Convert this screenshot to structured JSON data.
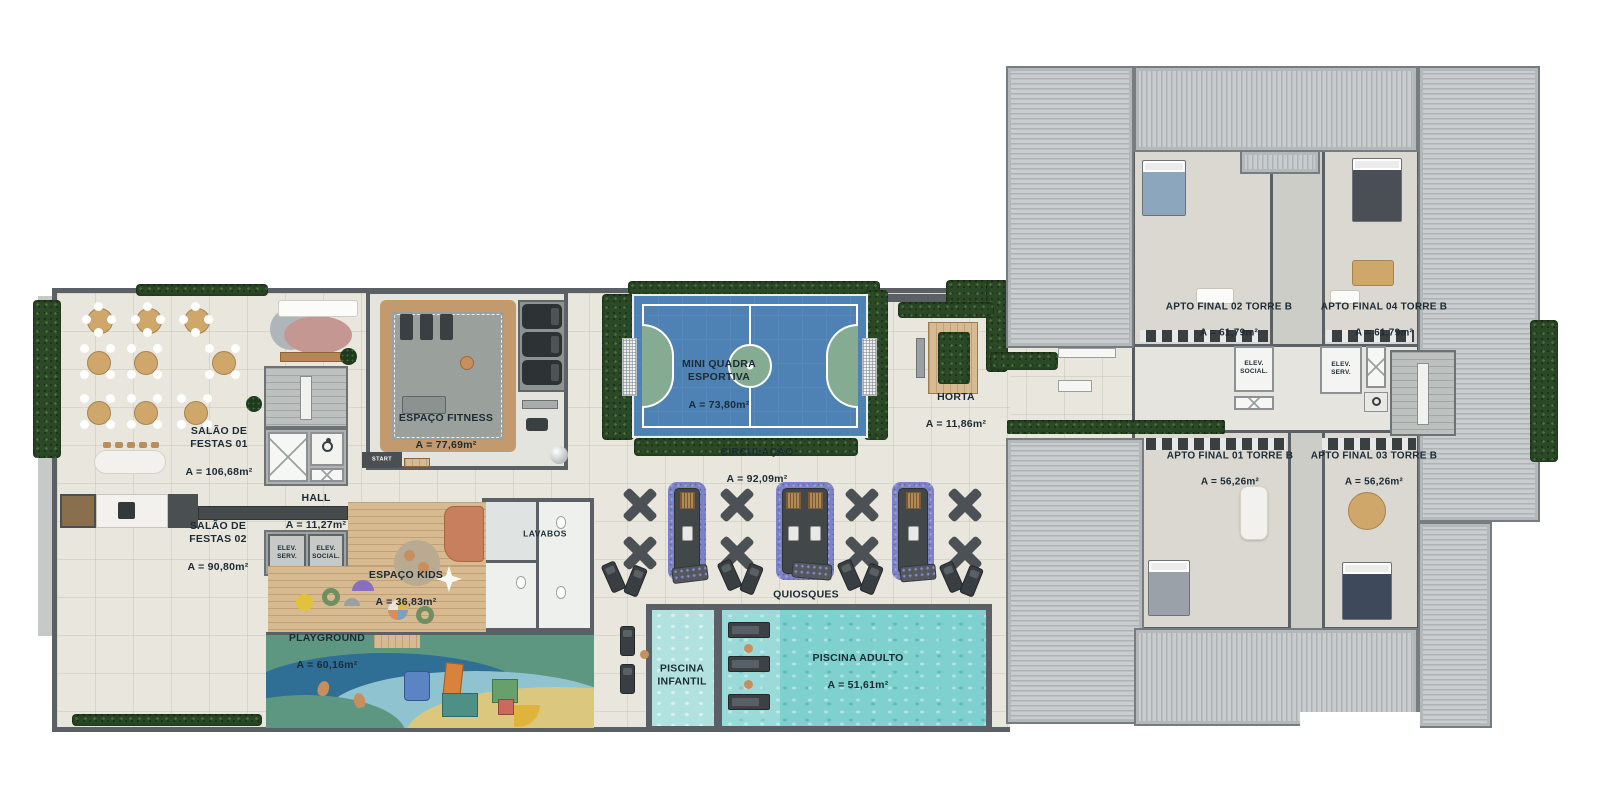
{
  "page": {
    "type": "condominium floor plan — amenities deck and Torre B apartments"
  },
  "colors": {
    "wall": "#5a6065",
    "floor": "#e9e6dd",
    "hedge": "#2c4927",
    "navy": "#1c2b35",
    "court": "#4e81b4",
    "court-green": "#85ab92",
    "track": "#c39a6d",
    "gym": "#9aa19d",
    "wood": "#d8ba90",
    "pool": "#7ed1cf",
    "poolk": "#b2e2df",
    "roof": "#c9cdcf",
    "plate": "#dad8d1",
    "corridor": "#e5e4df",
    "tan": "#cfa76b",
    "purple": "#8186c9",
    "orange": "#c77f5e",
    "pink": "#c59792"
  },
  "areas": {
    "salao_festas_01": {
      "name": "SALÃO DE\nFESTAS 01",
      "area": "A = 106,68m²"
    },
    "salao_festas_02": {
      "name": "SALÃO DE\nFESTAS 02",
      "area": "A = 90,80m²"
    },
    "hall": {
      "name": "HALL",
      "area": "A = 11,27m²"
    },
    "elev_serv_deck": {
      "name": "ELEV.\nSERV."
    },
    "elev_social_deck": {
      "name": "ELEV.\nSOCIAL."
    },
    "espaco_fitness": {
      "name": "ESPAÇO FITNESS",
      "area": "A = 77,69m²"
    },
    "start": {
      "name": "START"
    },
    "lavabos": {
      "name": "LAVABOS"
    },
    "espaco_kids": {
      "name": "ESPAÇO KIDS",
      "area": "A = 36,83m²"
    },
    "playground": {
      "name": "PLAYGROUND",
      "area": "A = 60,16m²"
    },
    "mini_quadra": {
      "name": "MINI QUADRA\nESPORTIVA",
      "area": "A = 73,80m²"
    },
    "circulacao": {
      "name": "CIRCULAÇÃO",
      "area": "A = 92,09m²"
    },
    "horta": {
      "name": "HORTA",
      "area": "A = 11,86m²"
    },
    "quiosques": {
      "name": "QUIOSQUES"
    },
    "piscina_infantil": {
      "name": "PISCINA\nINFANTIL"
    },
    "piscina_adulto": {
      "name": "PISCINA ADULTO",
      "area": "A = 51,61m²"
    },
    "apto_final_02": {
      "name": "APTO FINAL 02 TORRE B",
      "area": "A = 61,79m²"
    },
    "apto_final_04": {
      "name": "APTO FINAL 04 TORRE B",
      "area": "A = 61,79m²"
    },
    "apto_final_01": {
      "name": "APTO FINAL 01 TORRE B",
      "area": "A = 56,26m²"
    },
    "apto_final_03": {
      "name": "APTO FINAL 03 TORRE B",
      "area": "A = 56,26m²"
    },
    "elev_social_tower": {
      "name": "ELEV.\nSOCIAL."
    },
    "elev_serv_tower": {
      "name": "ELEV.\nSERV."
    }
  }
}
